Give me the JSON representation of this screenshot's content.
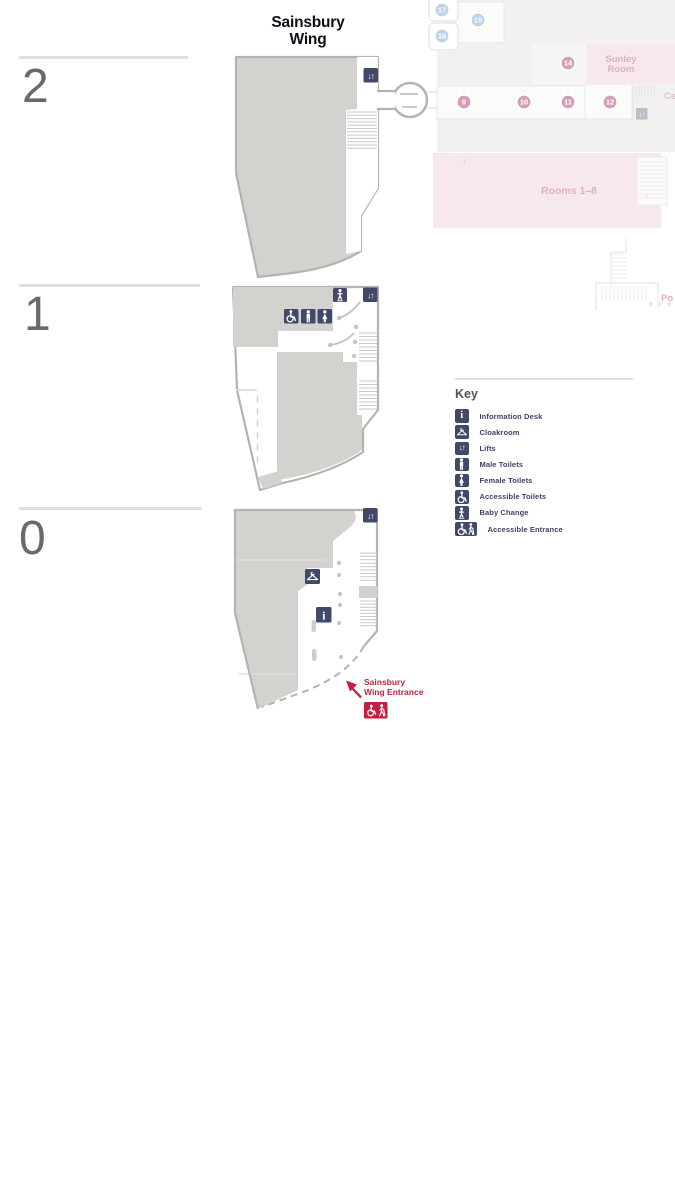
{
  "title": {
    "line1": "Sainsbury",
    "line2": "Wing"
  },
  "floors": [
    {
      "label": "2"
    },
    {
      "label": "1"
    },
    {
      "label": "0"
    }
  ],
  "entrance": {
    "line1": "Sainsbury",
    "line2": "Wing Entrance"
  },
  "key": {
    "title": "Key",
    "items": [
      {
        "icon": "information-icon",
        "label": "Information Desk"
      },
      {
        "icon": "cloakroom-icon",
        "label": "Cloakroom"
      },
      {
        "icon": "lifts-icon",
        "label": "Lifts"
      },
      {
        "icon": "male-toilets-icon",
        "label": "Male Toilets"
      },
      {
        "icon": "female-toilets-icon",
        "label": "Female Toilets"
      },
      {
        "icon": "accessible-toilets-icon",
        "label": "Accessible Toilets"
      },
      {
        "icon": "baby-change-icon",
        "label": "Baby Change"
      },
      {
        "icon": "accessible-entrance-icon",
        "label": "Accessible Entrance"
      }
    ]
  },
  "glyphs": {
    "lifts": "↓↑",
    "info": "i",
    "up_arrow": "↑",
    "down_arrow": "↓"
  },
  "background_building": {
    "room_circles": [
      {
        "number": "17",
        "color": "blue"
      },
      {
        "number": "16",
        "color": "blue"
      },
      {
        "number": "15",
        "color": "blue"
      },
      {
        "number": "14",
        "color": "pink"
      },
      {
        "number": "9",
        "color": "pink"
      },
      {
        "number": "10",
        "color": "pink"
      },
      {
        "number": "11",
        "color": "pink"
      },
      {
        "number": "12",
        "color": "pink"
      }
    ],
    "labels": {
      "sunley_line1": "Sunley",
      "sunley_line2": "Room",
      "rooms_range": "Rooms 1–8",
      "central_cut": "Ce",
      "portico_cut": "Po"
    }
  },
  "colors": {
    "icon_navy": "#424868",
    "entrance_red": "#c41f3e",
    "plan_fill_gray": "#d3d2cf",
    "plan_outline_gray": "#b5b3b0",
    "faded_pink_block": "#f7e9eb",
    "faded_pink_text": "#e0b0bd",
    "circle_pink": "#d39fb7",
    "circle_blue": "#bad4e9",
    "level_number_gray": "#696969"
  }
}
